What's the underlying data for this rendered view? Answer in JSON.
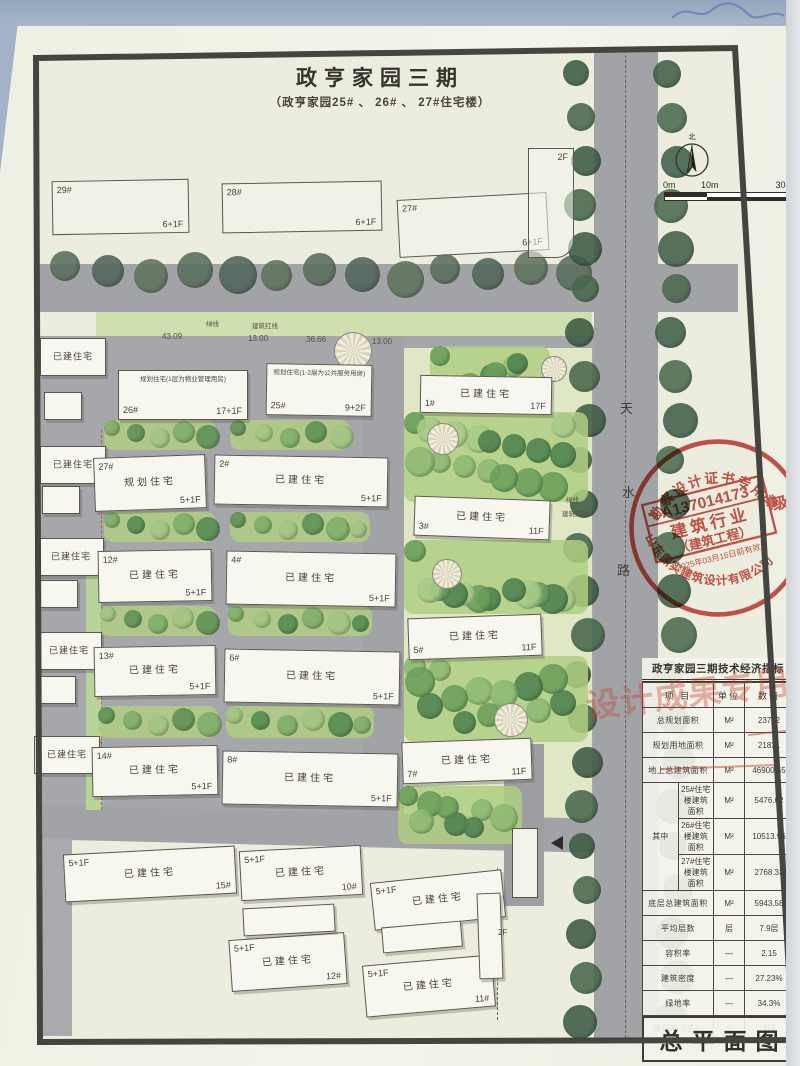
{
  "title": "政亨家园三期",
  "subtitle": "（政亨家园25# 、 26# 、 27#住宅楼）",
  "compass": {
    "north_label": "北"
  },
  "scale_bar": {
    "labels": [
      "0m",
      "10m",
      "30m"
    ]
  },
  "road": {
    "name_chars": [
      "天",
      "水",
      "路"
    ]
  },
  "lines": {
    "green_line": "绿线",
    "red_line": "建筑红线",
    "dimensions": [
      "43.09",
      "13.00",
      "36.66",
      "13.00"
    ]
  },
  "misc": {
    "existing": "已建住宅",
    "small_2f": "2F"
  },
  "top_buildings": [
    {
      "no": "29#",
      "floors": "6+1F"
    },
    {
      "no": "28#",
      "floors": "6+1F"
    },
    {
      "no": "27#",
      "floors": "6+1F"
    },
    {
      "no": "",
      "floors": "2F"
    }
  ],
  "bld": [
    {
      "no": "26#",
      "note": "规划住宅(1层为物业管理用房)",
      "floors": "17+1F"
    },
    {
      "no": "25#",
      "note": "规划住宅(1-2层为公共服务用房)",
      "floors": "9+2F"
    },
    {
      "no": "27#",
      "status": "规划住宅",
      "floors": "5+1F"
    },
    {
      "no": "2#",
      "status": "已建住宅",
      "floors": "5+1F"
    },
    {
      "no": "12#",
      "status": "已建住宅",
      "floors": "5+1F"
    },
    {
      "no": "4#",
      "status": "已建住宅",
      "floors": "5+1F"
    },
    {
      "no": "13#",
      "status": "已建住宅",
      "floors": "5+1F"
    },
    {
      "no": "6#",
      "status": "已建住宅",
      "floors": "5+1F"
    },
    {
      "no": "14#",
      "status": "已建住宅",
      "floors": "5+1F"
    },
    {
      "no": "8#",
      "status": "已建住宅",
      "floors": "5+1F"
    },
    {
      "no": "1#",
      "status": "已建住宅",
      "floors": "17F"
    },
    {
      "no": "3#",
      "status": "已建住宅",
      "floors": "11F"
    },
    {
      "no": "5#",
      "status": "已建住宅",
      "floors": "11F"
    },
    {
      "no": "7#",
      "status": "已建住宅",
      "floors": "11F"
    },
    {
      "no": "15#",
      "status": "已建住宅",
      "floors": "5+1F"
    },
    {
      "no": "10#",
      "status": "已建住宅",
      "floors": "5+1F"
    },
    {
      "no": "9#",
      "status": "已建住宅",
      "floors": "5+1F"
    },
    {
      "no": "12#",
      "status": "已建住宅",
      "floors": "5+1F"
    },
    {
      "no": "11#",
      "status": "已建住宅",
      "floors": "5+1F"
    }
  ],
  "stamp": {
    "arc_top": "勘察设计证书专用章",
    "cert_no": "A137014173",
    "line1": "建筑行业",
    "line2": "（建筑工程）",
    "grade": "级",
    "validity": "2025年03月16日前有效",
    "company": "山东鼎实建筑设计有限公司"
  },
  "table": {
    "title": "政亨家园三期技术经济指标",
    "headers": [
      "项 目",
      "单位",
      "数值"
    ],
    "among_label": "其中",
    "watermark": "设计成果专用章",
    "rows": [
      [
        "总规划面积",
        "M²",
        "23732"
      ],
      [
        "规划用地面积",
        "M²",
        "21831"
      ],
      [
        "地上总建筑面积",
        "M²",
        "46900.55"
      ],
      [
        "25#住宅楼建筑面积",
        "M²",
        "5476.62"
      ],
      [
        "26#住宅楼建筑面积",
        "M²",
        "10513.96"
      ],
      [
        "27#住宅楼建筑面积",
        "M²",
        "2768.33"
      ],
      [
        "底层总建筑面积",
        "M²",
        "5943.58"
      ],
      [
        "平均层数",
        "层",
        "7.9层"
      ],
      [
        "容积率",
        "—",
        "2.15"
      ],
      [
        "建筑密度",
        "—",
        "27.23%"
      ],
      [
        "绿地率",
        "—",
        "34.3%"
      ],
      [
        "停车库（位）",
        "个",
        "115"
      ]
    ]
  },
  "footer": {
    "drawing_label": "总平面图"
  }
}
